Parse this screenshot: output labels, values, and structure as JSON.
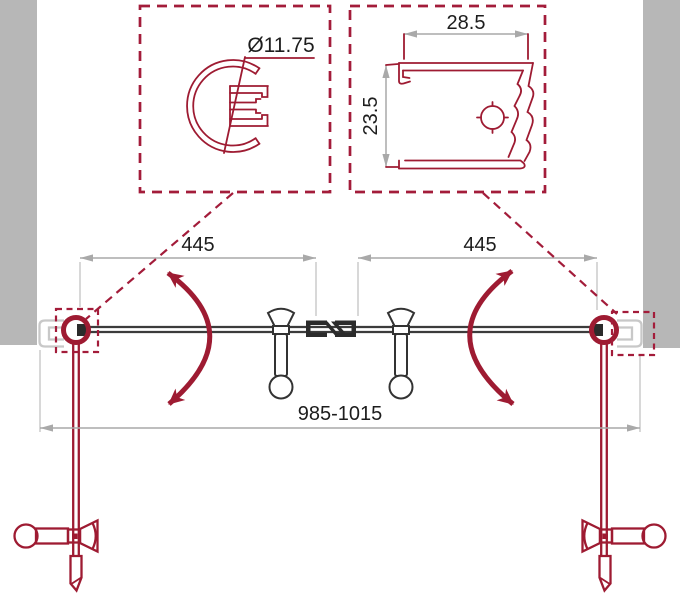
{
  "drawing": {
    "callouts": {
      "left": {
        "diameter_label": "Ø11.75"
      },
      "right": {
        "width_label": "28.5",
        "depth_label": "23.5"
      }
    },
    "dimensions": {
      "left_panel": "445",
      "right_panel": "445",
      "overall": "985-1015"
    },
    "colors": {
      "accent_red": "#9e1b32",
      "line_dark": "#3c3c3c",
      "wall_gray": "#b7b7b7",
      "dimension_gray": "#a9a9a9",
      "text": "#1d1d1d"
    }
  }
}
